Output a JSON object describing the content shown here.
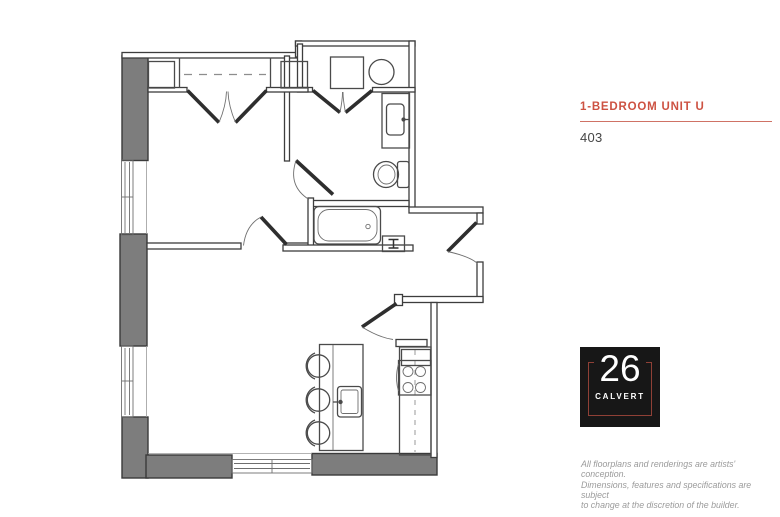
{
  "panel": {
    "title": "1-BEDROOM UNIT U",
    "unit_number": "403",
    "accent_color": "#cd5242",
    "rule_color": "#cf7265",
    "logo": {
      "number": "26",
      "name": "CALVERT",
      "background_color": "#171717",
      "frame_color": "#8f4036",
      "text_color": "#ffffff"
    },
    "disclaimer_lines": [
      "All floorplans and renderings are artists' conception.",
      "Dimensions, features and specifications are subject",
      "to change at the discretion of the builder."
    ]
  },
  "floorplan": {
    "wall_fill_color": "#7d7d7d",
    "line_color": "#3d3d3d",
    "fixtures": [
      "bedroom-closet",
      "washer",
      "dryer",
      "vanity-sink",
      "toilet",
      "bathtub",
      "utility-box",
      "refrigerator",
      "stove",
      "kitchen-counter",
      "kitchen-island",
      "island-sink",
      "bar-stools",
      "windows",
      "entry-door",
      "bedroom-door",
      "bathroom-door",
      "kitchen-door"
    ]
  }
}
